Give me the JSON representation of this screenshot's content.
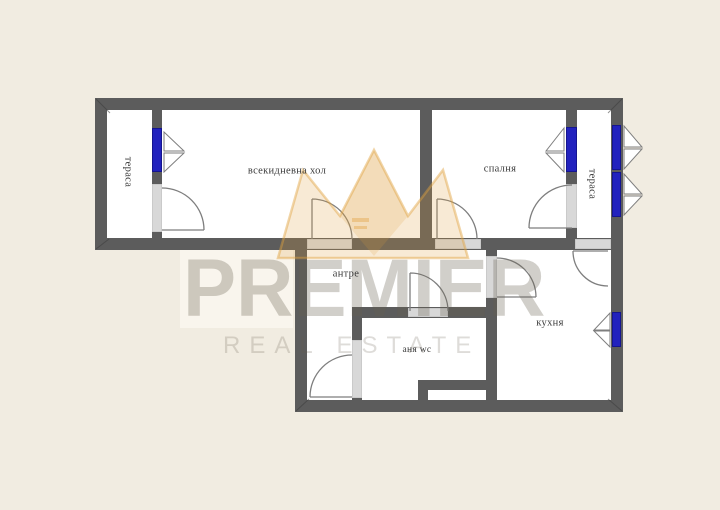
{
  "floorplan": {
    "rooms": [
      {
        "id": "terrace-left",
        "label": "тераса"
      },
      {
        "id": "living-room",
        "label": "всекидневна хол"
      },
      {
        "id": "bedroom",
        "label": "спалня"
      },
      {
        "id": "terrace-right",
        "label": "тераса"
      },
      {
        "id": "hallway",
        "label": "антре"
      },
      {
        "id": "bathroom",
        "label": "аня wc"
      },
      {
        "id": "kitchen",
        "label": "кухня"
      }
    ],
    "colors": {
      "background": "#f1ece1",
      "wall": "#5c5c5c",
      "room": "#ffffff",
      "door_opening": "#d8d8d8",
      "window": "#2222be"
    },
    "symbols": {
      "window_count": 5,
      "door_count": 8
    }
  },
  "watermark": {
    "brand": "PREMIER",
    "tagline": "REAL ESTATE",
    "logo": "crown-logo",
    "accent": "#e0a13e"
  }
}
